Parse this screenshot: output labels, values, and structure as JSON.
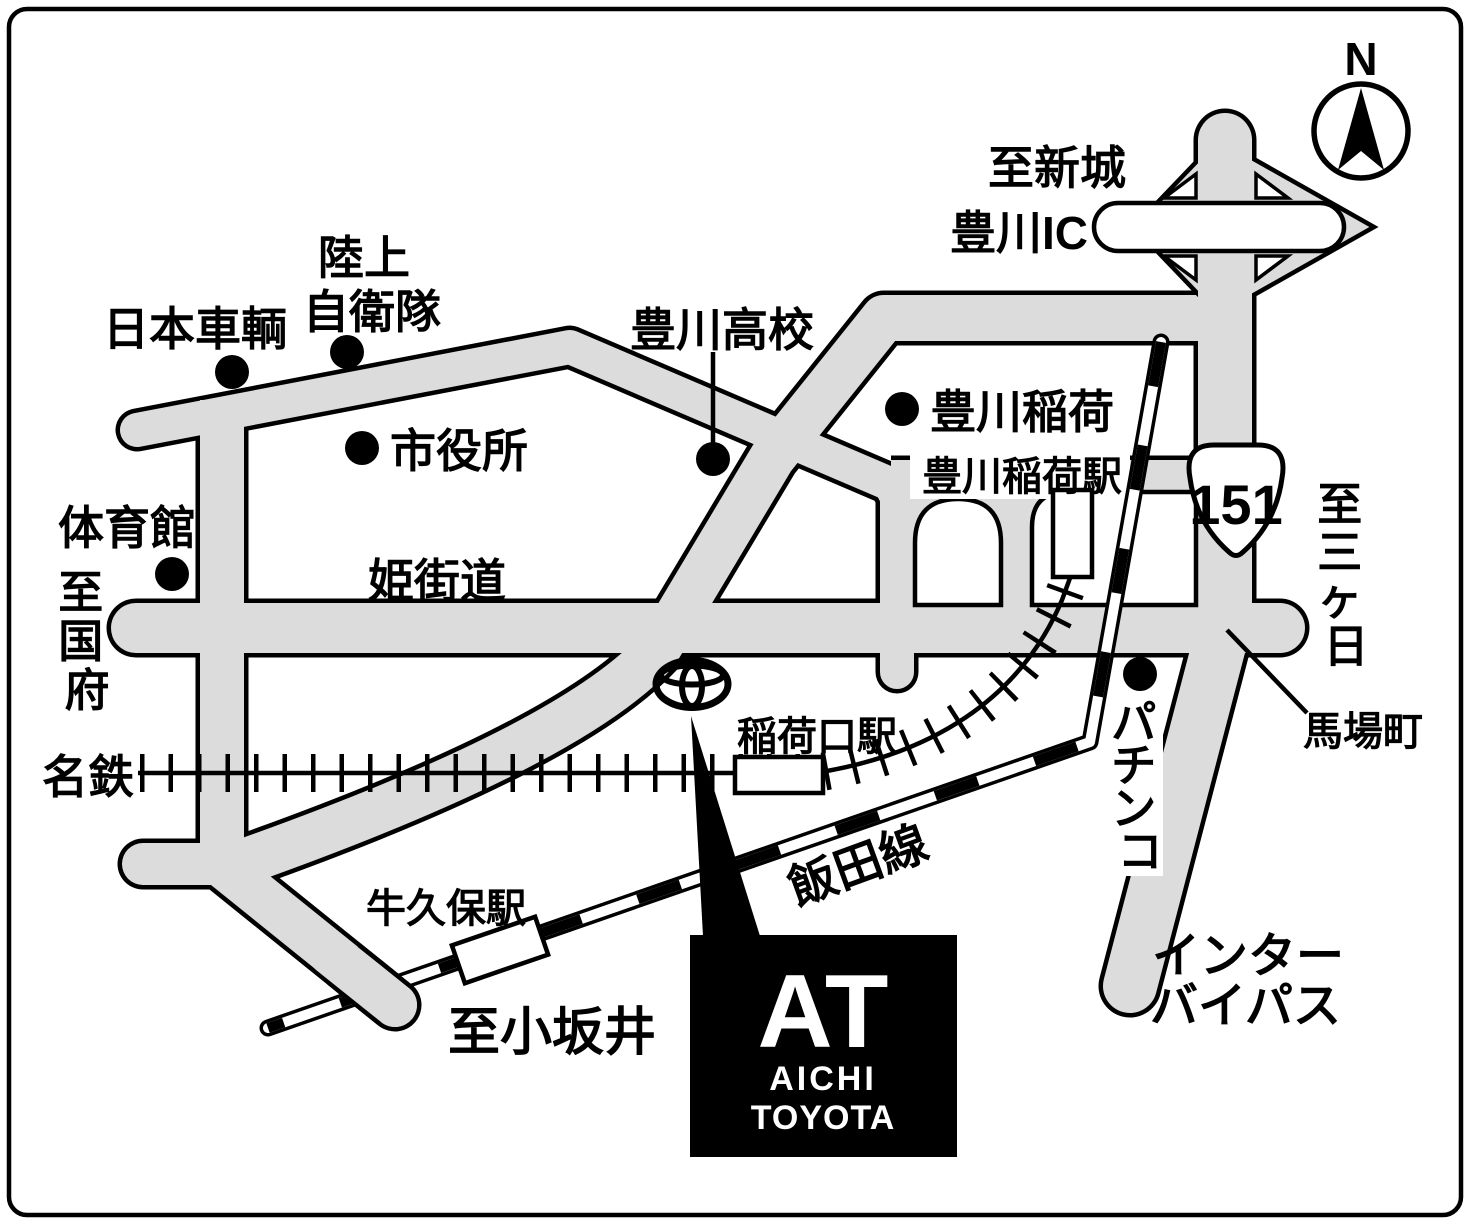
{
  "map_title": "Aichi Toyota Toyokawa access map",
  "colors": {
    "road": "#dcdcdc",
    "line": "#000000",
    "background": "#ffffff"
  },
  "compass": {
    "north": "N"
  },
  "route_badge": {
    "number": "151"
  },
  "labels": {
    "to_shinshiro": "至新城",
    "toyokawa_ic": "豊川IC",
    "to_mikkabi": [
      "至",
      "三",
      "ヶ",
      "日"
    ],
    "baba_cho": "馬場町",
    "rikujo_line1": "陸上",
    "rikujo_line2": "自衛隊",
    "nippon_sharyo": "日本車輌",
    "shiyakusho": "市役所",
    "toyokawa_koko": "豊川高校",
    "toyokawa_inari": "豊川稲荷",
    "toyokawa_inari_station": "豊川稲荷駅",
    "taiikukan": "体育館",
    "to_kokufu": [
      "至",
      "国",
      "府"
    ],
    "hime_kaido": "姫街道",
    "meitetsu": "名鉄",
    "inariguchi_station": "稲荷口駅",
    "pachinko": [
      "パ",
      "チ",
      "ン",
      "コ"
    ],
    "iida_line": "飯田線",
    "ushikubo_station": "牛久保駅",
    "to_kozakai": "至小坂井",
    "inter_bypass_line1": "インター",
    "inter_bypass_line2": "バイパス"
  },
  "dealer_logo": {
    "monogram": "AT",
    "name_line1": "AICHI",
    "name_line2": "TOYOTA"
  }
}
